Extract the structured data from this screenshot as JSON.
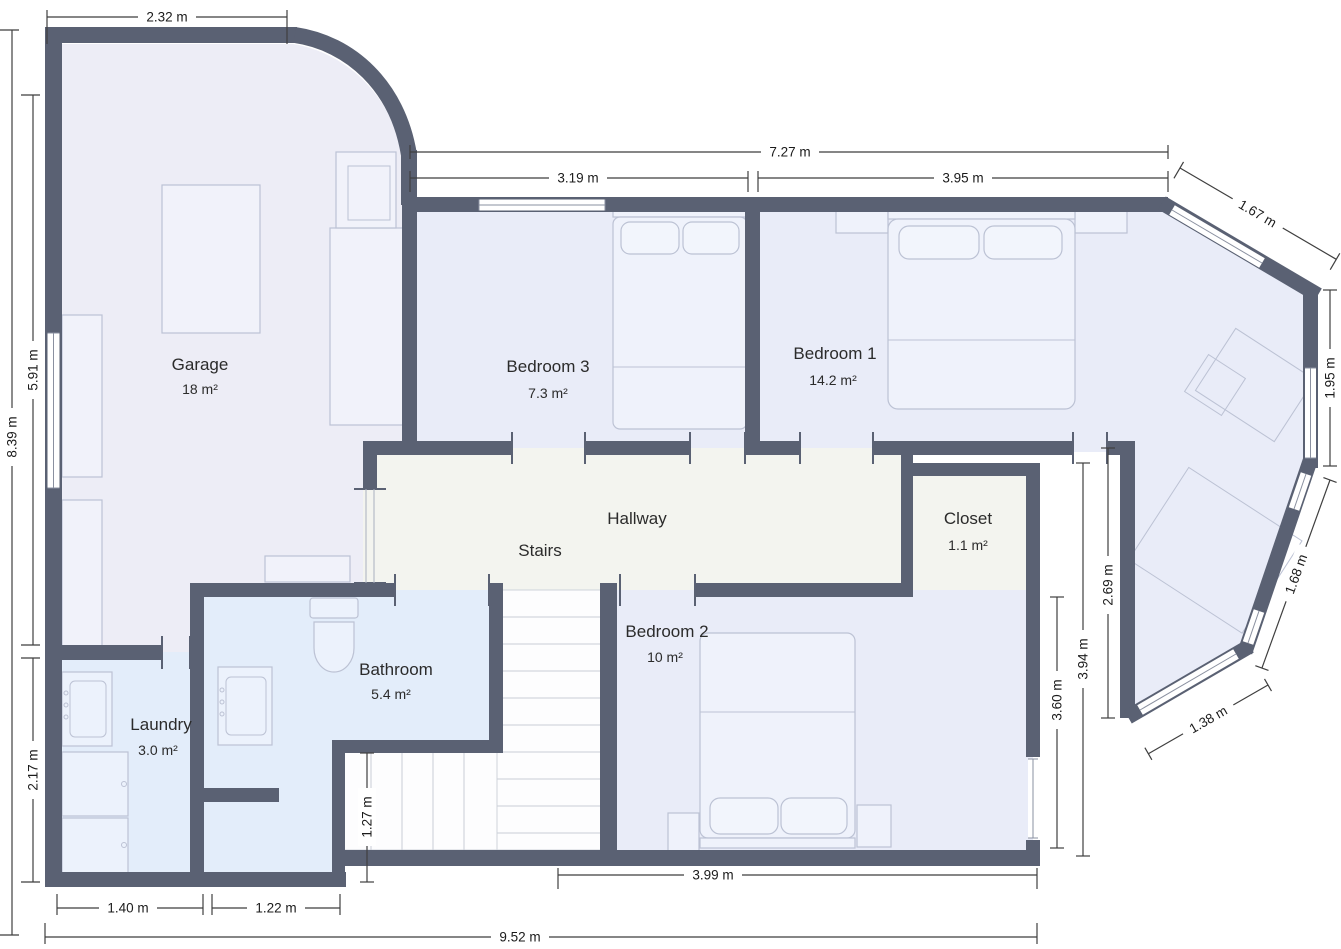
{
  "plan": {
    "rooms": [
      {
        "id": "garage",
        "name": "Garage",
        "area": "18 m²"
      },
      {
        "id": "bedroom3",
        "name": "Bedroom 3",
        "area": "7.3 m²"
      },
      {
        "id": "bedroom1",
        "name": "Bedroom 1",
        "area": "14.2 m²"
      },
      {
        "id": "hallway",
        "name": "Hallway",
        "area": ""
      },
      {
        "id": "stairs",
        "name": "Stairs",
        "area": ""
      },
      {
        "id": "closet",
        "name": "Closet",
        "area": "1.1 m²"
      },
      {
        "id": "bathroom",
        "name": "Bathroom",
        "area": "5.4 m²"
      },
      {
        "id": "laundry",
        "name": "Laundry",
        "area": "3.0 m²"
      },
      {
        "id": "bedroom2",
        "name": "Bedroom 2",
        "area": "10 m²"
      }
    ],
    "dimensions": {
      "garage_top_width": "2.32 m",
      "bedrooms_top_total": "7.27 m",
      "bedroom3_width": "3.19 m",
      "bedroom1_width": "3.95 m",
      "bay_upper_wall": "1.67 m",
      "bay_right_wall": "1.95 m",
      "bay_lower_wall": "1.68 m",
      "bay_bottom_wall": "1.38 m",
      "garage_left_height": "5.91 m",
      "left_total_height": "8.39 m",
      "laundry_left_height": "2.17 m",
      "laundry_bottom_width": "1.40 m",
      "bathroom_bottom_width": "1.22 m",
      "bottom_total_width": "9.52 m",
      "stairs_lower_height": "1.27 m",
      "bedroom2_bottom_width": "3.99 m",
      "bedroom2_right_height": "3.60 m",
      "closet_bedroom2_height": "3.94 m",
      "bay_west_wall": "2.69 m"
    },
    "colors": {
      "wall": "#5a6173",
      "bedroom_fill": "#e9ecf8",
      "garage_fill": "#ededf6",
      "bath_laundry_fill": "#e3edfa",
      "hallway_fill": "#f3f4ef",
      "stairs_fill": "#fdfdfe",
      "furniture_stroke": "#bcc2d4",
      "dimension_line": "#3f3f3f",
      "label_text": "#2b2b2b"
    }
  }
}
